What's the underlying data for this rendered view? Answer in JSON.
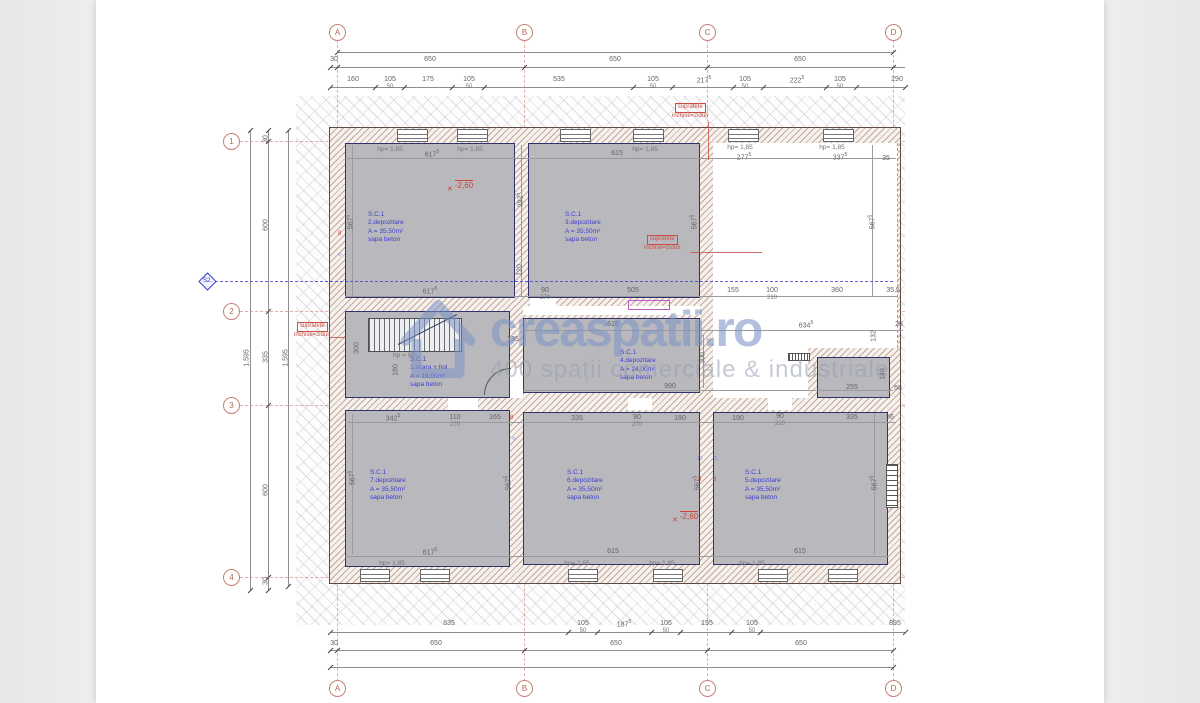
{
  "watermark": {
    "brand": "creaspatii.ro",
    "tagline": "400 spații comerciale & industriale"
  },
  "colors": {
    "room_fill": "#b9b9bd",
    "room_text": "#3d3dd2",
    "wall_hatch": "#986d5c",
    "axis": "#c28274",
    "annotation_red": "#c94f43",
    "section_blue": "#4646d2",
    "dim_text": "#636369"
  },
  "plan": {
    "axes": {
      "cols": [
        {
          "id": "A",
          "x": 337
        },
        {
          "id": "B",
          "x": 524
        },
        {
          "id": "C",
          "x": 707
        },
        {
          "id": "D",
          "x": 893
        }
      ],
      "rows": [
        {
          "id": "1",
          "y": 141
        },
        {
          "id": "2",
          "y": 311
        },
        {
          "id": "3",
          "y": 405
        },
        {
          "id": "4",
          "y": 577
        }
      ]
    },
    "section": {
      "id": "S2",
      "x": 207,
      "y": 281,
      "x2": 895
    },
    "dim_lines": [
      {
        "o": "h",
        "y": 52,
        "x1": 337,
        "x2": 893,
        "ticks": [
          337,
          893
        ]
      },
      {
        "o": "h",
        "y": 67,
        "x1": 330,
        "x2": 905,
        "ticks": [
          330,
          337,
          524,
          707,
          893
        ]
      },
      {
        "o": "h",
        "y": 87,
        "x1": 330,
        "x2": 905,
        "ticks": [
          330,
          375,
          404,
          452,
          484,
          633,
          672,
          733,
          763,
          826,
          856,
          905
        ]
      },
      {
        "o": "h",
        "y": 632,
        "x1": 330,
        "x2": 905,
        "ticks": [
          330,
          568,
          597,
          651,
          680,
          731,
          760,
          905
        ]
      },
      {
        "o": "h",
        "y": 650,
        "x1": 330,
        "x2": 893,
        "ticks": [
          330,
          337,
          524,
          707,
          893
        ]
      },
      {
        "o": "h",
        "y": 667,
        "x1": 330,
        "x2": 893,
        "ticks": [
          330,
          893
        ]
      },
      {
        "o": "v",
        "x": 250,
        "y1": 130,
        "y2": 590,
        "ticks": [
          130,
          590
        ]
      },
      {
        "o": "v",
        "x": 268,
        "y1": 130,
        "y2": 590,
        "ticks": [
          130,
          141,
          311,
          405,
          577,
          590
        ]
      },
      {
        "o": "v",
        "x": 288,
        "y1": 130,
        "y2": 586,
        "ticks": [
          130,
          586
        ]
      },
      {
        "o": "h",
        "y": 158,
        "x1": 345,
        "x2": 896,
        "ticks": [],
        "int": true
      },
      {
        "o": "h",
        "y": 296,
        "x1": 345,
        "x2": 898,
        "ticks": [],
        "int": true
      },
      {
        "o": "h",
        "y": 330,
        "x1": 523,
        "x2": 903,
        "ticks": [],
        "int": true
      },
      {
        "o": "h",
        "y": 390,
        "x1": 523,
        "x2": 893,
        "ticks": [],
        "int": true
      },
      {
        "o": "h",
        "y": 422,
        "x1": 345,
        "x2": 896,
        "ticks": [],
        "int": true
      },
      {
        "o": "h",
        "y": 556,
        "x1": 345,
        "x2": 888,
        "ticks": [],
        "int": true
      },
      {
        "o": "v",
        "x": 352,
        "y1": 145,
        "y2": 296,
        "ticks": [],
        "int": true
      },
      {
        "o": "v",
        "x": 521,
        "y1": 145,
        "y2": 296,
        "ticks": [],
        "int": true
      },
      {
        "o": "v",
        "x": 872,
        "y1": 145,
        "y2": 296,
        "ticks": [],
        "int": true
      },
      {
        "o": "v",
        "x": 703,
        "y1": 335,
        "y2": 388,
        "ticks": [],
        "int": true
      },
      {
        "o": "v",
        "x": 352,
        "y1": 414,
        "y2": 554,
        "ticks": [],
        "int": true
      },
      {
        "o": "v",
        "x": 874,
        "y1": 414,
        "y2": 554,
        "ticks": [],
        "int": true
      }
    ],
    "texts": [
      {
        "t": "30",
        "x": 334,
        "y": 56,
        "c": "d"
      },
      {
        "t": "650",
        "x": 430,
        "y": 56,
        "c": "d"
      },
      {
        "t": "650",
        "x": 615,
        "y": 56,
        "c": "d"
      },
      {
        "t": "650",
        "x": 800,
        "y": 56,
        "c": "d"
      },
      {
        "t": "160",
        "x": 353,
        "y": 76,
        "c": "d"
      },
      {
        "t": "105",
        "s": "50",
        "x": 390,
        "y": 76,
        "c": "d"
      },
      {
        "t": "175",
        "x": 428,
        "y": 76,
        "c": "d"
      },
      {
        "t": "105",
        "s": "50",
        "x": 469,
        "y": 76,
        "c": "d"
      },
      {
        "t": "535",
        "x": 559,
        "y": 76,
        "c": "d"
      },
      {
        "t": "105",
        "s": "50",
        "x": 653,
        "y": 76,
        "c": "d"
      },
      {
        "t": "217",
        "p": "5",
        "x": 704,
        "y": 76,
        "c": "d"
      },
      {
        "t": "105",
        "s": "50",
        "x": 745,
        "y": 76,
        "c": "d"
      },
      {
        "t": "222",
        "p": "5",
        "x": 797,
        "y": 76,
        "c": "d"
      },
      {
        "t": "105",
        "s": "50",
        "x": 840,
        "y": 76,
        "c": "d"
      },
      {
        "t": "290",
        "x": 897,
        "y": 76,
        "c": "d"
      },
      {
        "t": "835",
        "x": 449,
        "y": 620,
        "c": "d"
      },
      {
        "t": "105",
        "s": "50",
        "x": 583,
        "y": 620,
        "c": "d"
      },
      {
        "t": "187",
        "p": "5",
        "x": 624,
        "y": 620,
        "c": "d"
      },
      {
        "t": "105",
        "s": "50",
        "x": 666,
        "y": 620,
        "c": "d"
      },
      {
        "t": "195",
        "x": 707,
        "y": 620,
        "c": "d"
      },
      {
        "t": "105",
        "s": "50",
        "x": 752,
        "y": 620,
        "c": "d"
      },
      {
        "t": "895",
        "x": 895,
        "y": 620,
        "c": "d"
      },
      {
        "t": "30",
        "x": 334,
        "y": 640,
        "c": "d"
      },
      {
        "t": "650",
        "x": 436,
        "y": 640,
        "c": "d"
      },
      {
        "t": "650",
        "x": 616,
        "y": 640,
        "c": "d"
      },
      {
        "t": "650",
        "x": 801,
        "y": 640,
        "c": "d"
      },
      {
        "t": "1,595",
        "x": 247,
        "y": 358,
        "c": "v"
      },
      {
        "t": "30",
        "x": 266,
        "y": 139,
        "c": "v"
      },
      {
        "t": "600",
        "x": 266,
        "y": 225,
        "c": "v"
      },
      {
        "t": "335",
        "x": 266,
        "y": 357,
        "c": "v"
      },
      {
        "t": "600",
        "x": 266,
        "y": 490,
        "c": "v"
      },
      {
        "t": "30",
        "x": 266,
        "y": 581,
        "c": "v"
      },
      {
        "t": "1,595",
        "x": 286,
        "y": 358,
        "c": "v"
      },
      {
        "t": "617",
        "p": "5",
        "x": 432,
        "y": 150,
        "c": "d"
      },
      {
        "t": "615",
        "x": 617,
        "y": 150,
        "c": "d"
      },
      {
        "t": "277",
        "p": "5",
        "x": 744,
        "y": 153,
        "c": "d"
      },
      {
        "t": "337",
        "p": "5",
        "x": 840,
        "y": 153,
        "c": "d"
      },
      {
        "t": "35",
        "x": 886,
        "y": 155,
        "c": "d"
      },
      {
        "t": "hp= 1,85",
        "x": 390,
        "y": 146,
        "c": "hp"
      },
      {
        "t": "hp= 1,85",
        "x": 470,
        "y": 146,
        "c": "hp"
      },
      {
        "t": "hp= 1,85",
        "x": 645,
        "y": 146,
        "c": "hp"
      },
      {
        "t": "hp= 1,85",
        "x": 740,
        "y": 144,
        "c": "hp"
      },
      {
        "t": "hp= 1,85",
        "x": 832,
        "y": 144,
        "c": "hp"
      },
      {
        "t": "567",
        "p": "5",
        "x": 350,
        "y": 222,
        "c": "v"
      },
      {
        "t": "392",
        "p": "5",
        "x": 520,
        "y": 200,
        "c": "v"
      },
      {
        "t": "120",
        "x": 520,
        "y": 270,
        "c": "v"
      },
      {
        "t": "567",
        "p": "5",
        "x": 694,
        "y": 222,
        "c": "v"
      },
      {
        "t": "567",
        "p": "5",
        "x": 872,
        "y": 222,
        "c": "v"
      },
      {
        "t": "617",
        "p": "5",
        "x": 430,
        "y": 287,
        "c": "d"
      },
      {
        "t": "90",
        "s": "270",
        "x": 545,
        "y": 287,
        "c": "d"
      },
      {
        "t": "505",
        "x": 633,
        "y": 287,
        "c": "d"
      },
      {
        "t": "155",
        "x": 733,
        "y": 287,
        "c": "d"
      },
      {
        "t": "100",
        "s": "210",
        "x": 772,
        "y": 287,
        "c": "d"
      },
      {
        "t": "360",
        "x": 837,
        "y": 287,
        "c": "d"
      },
      {
        "t": "35,5",
        "x": 893,
        "y": 287,
        "c": "d"
      },
      {
        "t": "hp = 95",
        "x": 404,
        "y": 352,
        "c": "hp"
      },
      {
        "t": "300",
        "x": 357,
        "y": 348,
        "c": "v"
      },
      {
        "t": "180",
        "x": 396,
        "y": 370,
        "c": "v"
      },
      {
        "t": "135",
        "x": 513,
        "y": 336,
        "c": "d"
      },
      {
        "t": "615",
        "x": 613,
        "y": 321,
        "c": "d"
      },
      {
        "t": "634",
        "p": "5",
        "x": 806,
        "y": 321,
        "c": "d"
      },
      {
        "t": "28",
        "x": 899,
        "y": 321,
        "c": "d"
      },
      {
        "t": "132",
        "x": 874,
        "y": 336,
        "c": "v"
      },
      {
        "t": "990",
        "x": 670,
        "y": 383,
        "c": "d"
      },
      {
        "t": "300",
        "x": 703,
        "y": 358,
        "c": "v"
      },
      {
        "t": "255",
        "x": 852,
        "y": 384,
        "c": "d"
      },
      {
        "t": "148",
        "x": 883,
        "y": 374,
        "c": "v"
      },
      {
        "t": "58",
        "x": 898,
        "y": 385,
        "c": "d"
      },
      {
        "t": "342",
        "p": "5",
        "x": 393,
        "y": 414,
        "c": "d"
      },
      {
        "t": "110",
        "s": "270",
        "x": 455,
        "y": 414,
        "c": "d"
      },
      {
        "t": "165",
        "x": 495,
        "y": 414,
        "c": "d"
      },
      {
        "t": "335",
        "x": 577,
        "y": 415,
        "c": "d"
      },
      {
        "t": "90",
        "s": "270",
        "x": 637,
        "y": 414,
        "c": "d"
      },
      {
        "t": "190",
        "x": 680,
        "y": 415,
        "c": "d"
      },
      {
        "t": "190",
        "x": 738,
        "y": 415,
        "c": "d"
      },
      {
        "t": "90",
        "s": "210",
        "x": 780,
        "y": 413,
        "c": "d"
      },
      {
        "t": "335",
        "x": 852,
        "y": 414,
        "c": "d"
      },
      {
        "t": "56",
        "x": 890,
        "y": 414,
        "c": "d"
      },
      {
        "t": "567",
        "p": "5",
        "x": 352,
        "y": 478,
        "c": "v"
      },
      {
        "t": "567",
        "p": "5",
        "x": 508,
        "y": 483,
        "c": "v"
      },
      {
        "t": "567",
        "p": "5",
        "x": 697,
        "y": 483,
        "c": "v"
      },
      {
        "t": "567",
        "p": "5",
        "x": 874,
        "y": 483,
        "c": "v"
      },
      {
        "t": "617",
        "p": "5",
        "x": 430,
        "y": 548,
        "c": "d"
      },
      {
        "t": "615",
        "x": 613,
        "y": 548,
        "c": "d"
      },
      {
        "t": "615",
        "x": 800,
        "y": 548,
        "c": "d"
      },
      {
        "t": "hp= 1,85",
        "x": 392,
        "y": 560,
        "c": "hp"
      },
      {
        "t": "hp= 1,85",
        "x": 577,
        "y": 560,
        "c": "hp"
      },
      {
        "t": "hp= 1,85",
        "x": 662,
        "y": 560,
        "c": "hp"
      },
      {
        "t": "hp= 1,85",
        "x": 752,
        "y": 560,
        "c": "hp"
      }
    ],
    "rooms": [
      {
        "x": 368,
        "y": 211,
        "lines": [
          "S.C.1",
          "2.depozitare",
          "A = 35,50m²",
          "sapa beton"
        ]
      },
      {
        "x": 565,
        "y": 211,
        "lines": [
          "S.C.1",
          "3.depozitare",
          "A = 35,50m²",
          "sapa beton"
        ]
      },
      {
        "x": 410,
        "y": 356,
        "lines": [
          "S.C.1",
          "1.scara + hol",
          "A = 19,00m²",
          "sapa beton"
        ]
      },
      {
        "x": 620,
        "y": 349,
        "lines": [
          "S.C.1",
          "4.depozitare",
          "A = 24,00m²",
          "sapa beton"
        ]
      },
      {
        "x": 370,
        "y": 469,
        "lines": [
          "S.C.1",
          "7.depozitare",
          "A = 35,50m²",
          "sapa beton"
        ]
      },
      {
        "x": 567,
        "y": 469,
        "lines": [
          "S.C.1",
          "6.depozitare",
          "A = 35,50m²",
          "sapa beton"
        ]
      },
      {
        "x": 745,
        "y": 469,
        "lines": [
          "S.C.1",
          "5.depozitare",
          "A = 35,50m²",
          "sapa beton"
        ]
      }
    ],
    "notes": [
      {
        "x": 672,
        "y": 103,
        "lines": [
          "suprafete",
          "inchise=ziduri"
        ],
        "leader": {
          "x": 708,
          "y": 122,
          "w": 1,
          "h": 38
        }
      },
      {
        "x": 644,
        "y": 235,
        "lines": [
          "suprafete",
          "inchise=ziduri"
        ],
        "leader": {
          "x": 690,
          "y": 252,
          "w": 72,
          "h": 1
        }
      },
      {
        "x": 294,
        "y": 322,
        "lines": [
          "suprafete",
          "inchise=ziduri"
        ],
        "leader": {
          "x": 330,
          "y": 337,
          "w": 16,
          "h": 1
        }
      }
    ],
    "levels": [
      {
        "t": "-2,60",
        "x": 447,
        "y": 181
      },
      {
        "t": "-2,60",
        "x": 672,
        "y": 512
      }
    ]
  }
}
